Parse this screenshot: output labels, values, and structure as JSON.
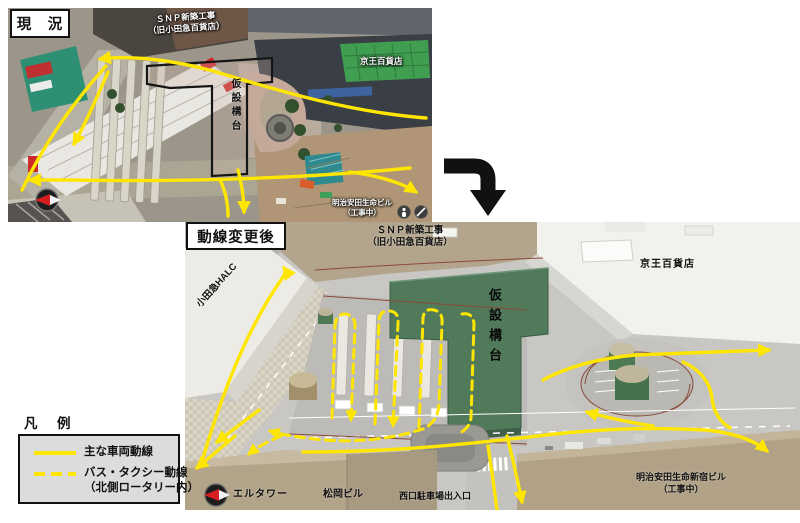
{
  "colors": {
    "flow_yellow": "#ffe600",
    "big_arrow": "#111111",
    "platform_green": "#507a5a"
  },
  "current": {
    "title": "現　況",
    "snp_line1": "ＳＮＰ新築工事",
    "snp_line2": "（旧小田急百貨店）",
    "keio": "京王百貨店",
    "kasetsu": "仮設構台",
    "meiji_line1": "明治安田生命ビル",
    "meiji_line2": "（工事中）"
  },
  "after": {
    "title": "動線変更後",
    "snp_line1": "ＳＮＰ新築工事",
    "snp_line2": "（旧小田急百貨店）",
    "keio": "京王百貨店",
    "kasetsu": "仮設構台",
    "halc": "小田急HALC",
    "eltower": "エルタワー",
    "matsuoka": "松岡ビル",
    "parking": "西口駐車場出入口",
    "meiji_line1": "明治安田生命新宿ビル",
    "meiji_line2": "（工事中）"
  },
  "legend": {
    "title": "凡　例",
    "item1_label": "主な車両動線",
    "item2_label1": "バス・タクシー動線",
    "item2_label2": "（北側ロータリー内）"
  }
}
